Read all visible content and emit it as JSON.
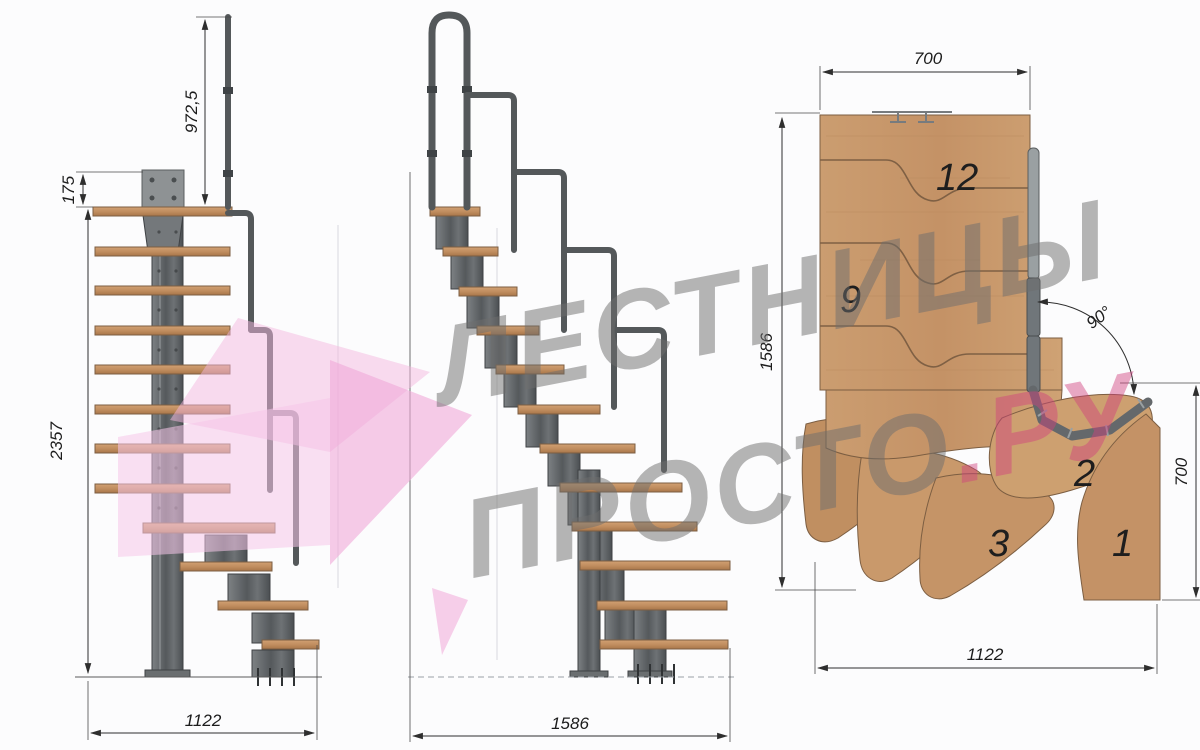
{
  "watermark": {
    "line1": "ЛЕСТНИЦЫ",
    "line2": "ПРОСТО",
    "line2_accent": ".РУ"
  },
  "side_view": {
    "dim_rail_height": "972,5",
    "dim_plate_offset": "175",
    "dim_total_height": "2357",
    "dim_run": "1122"
  },
  "front_view": {
    "dim_run": "1586"
  },
  "plan_view": {
    "dim_top_width": "700",
    "dim_left_depth": "1586",
    "dim_right_run": "700",
    "dim_bottom_width": "1122",
    "dim_turn_angle": "90°",
    "tread_numbers": [
      "12",
      "9",
      "3",
      "2",
      "1"
    ]
  },
  "palette": {
    "wood": "#c79a6d",
    "wood_dark": "#a9764a",
    "metal": "#606467",
    "dimension_line": "#2e2e2e",
    "watermark_gray": "#6e6e6e",
    "watermark_pink": "#d1417f",
    "arrow_pink": "#f4b9e1"
  }
}
